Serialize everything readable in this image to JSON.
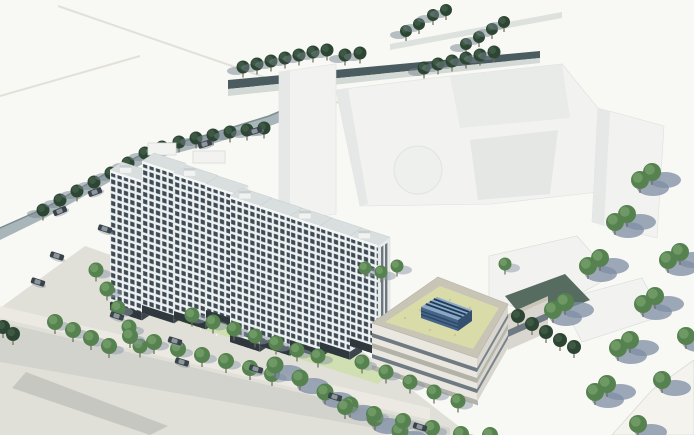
{
  "scene": {
    "type": "architectural-aerial-rendering",
    "view": "bird's-eye view of a mixed-use development massing study",
    "objects": {
      "residential_towers": "two clusters of slab apartment towers with gridded window facades",
      "green_roof_building": "low-rise banded building with sedum green roof and blue rooftop skylight",
      "context_buildings": "white untextured massing blocks of surrounding city",
      "street_trees": "rows of round street trees casting shadows",
      "cars": "small cars on roads and parking areas",
      "roads": "tree-lined streets, sidewalks and a parking lot"
    }
  },
  "colors": {
    "bg": "#f8f8f4",
    "faintLine": "#e2e0d8",
    "roadTop": "#4b5c60",
    "roadTopWalk": "#d3d9d5",
    "roadLeft": "#a9b6b9",
    "roadLeftEdge": "#7c8d92",
    "plaza": "#e0dfd8",
    "street": "#d3d3cd",
    "pavement": "#c7c7c1",
    "sidewalk": "#eceae3",
    "stall": "#fafaf8",
    "lawn": "#cfe0ae",
    "massing": "#f2f3f0",
    "massingShade": "#e5e8e6",
    "massingDeep": "#dde1df",
    "massingEdge": "#d8dbd7",
    "towerWin": "#3e4b55",
    "towerGrid": "#eef1f2",
    "towerGable": "#e7eaea",
    "towerStrip": "#59636b",
    "towerRoof": "#d9dedf",
    "towerBase": "#2f383d",
    "towerParapet": "#f6f8f8",
    "roofField": "#d9dba8",
    "roofSpeck": "#c7c994",
    "parapet": "#c8c5b6",
    "wall": "#e9e7df",
    "wallRight": "#d8d6ce",
    "wallBand": "#b2b2a8",
    "wallGlass": "#707a82",
    "skyTop": "#8aa8c6",
    "skyStripe": "#1f3c57",
    "skyFront": "#46648a",
    "skySide": "#35506f",
    "hedge": "#3c5348",
    "treeDark": "#2d4634",
    "treeDarkHi": "#44604a",
    "treeMid": "#55824f",
    "treeMidHi": "#7aa36e",
    "trunk": "#6f6a5c",
    "shadowBig": "#7d8ea4",
    "shadowSm": "#8b97a6",
    "shadowSw": "#76848d",
    "car": "#3a424a",
    "carHi": "#9aa4ab",
    "wedge": "#f4f3ee"
  },
  "towers": {
    "facadeSlope": 0.325,
    "endWidth": 12,
    "endSlope": -0.66,
    "clusters": [
      {
        "name": "tower-cluster-west",
        "slabs": [
          {
            "x": 110,
            "y": 170,
            "w": 32,
            "h": 140,
            "box": true
          },
          {
            "x": 142,
            "y": 161,
            "w": 32,
            "h": 152,
            "box": false
          },
          {
            "x": 174,
            "y": 173,
            "w": 32,
            "h": 146,
            "box": true
          },
          {
            "x": 206,
            "y": 184,
            "w": 30,
            "h": 134,
            "box": false
          }
        ]
      },
      {
        "name": "tower-cluster-east",
        "slabs": [
          {
            "x": 230,
            "y": 196,
            "w": 30,
            "h": 146,
            "box": true
          },
          {
            "x": 260,
            "y": 206,
            "w": 30,
            "h": 140,
            "box": false
          },
          {
            "x": 290,
            "y": 216,
            "w": 30,
            "h": 132,
            "box": true
          },
          {
            "x": 320,
            "y": 226,
            "w": 30,
            "h": 124,
            "box": false
          },
          {
            "x": 350,
            "y": 236,
            "w": 28,
            "h": 110,
            "box": true
          }
        ]
      }
    ]
  },
  "treeRows": [
    {
      "name": "north-upper-row",
      "kind": "treeDark",
      "shadow": "sw",
      "r": 6,
      "layer": "back",
      "pts": [
        [
          406,
          31
        ],
        [
          419,
          24
        ],
        [
          433,
          15
        ],
        [
          446,
          10
        ],
        [
          466,
          44
        ],
        [
          479,
          37
        ],
        [
          492,
          29
        ],
        [
          504,
          22
        ]
      ]
    },
    {
      "name": "north-road-row",
      "kind": "treeDark",
      "shadow": "sw",
      "r": 6.5,
      "layer": "back",
      "pts": [
        [
          243,
          67
        ],
        [
          257,
          64
        ],
        [
          271,
          61
        ],
        [
          285,
          58
        ],
        [
          299,
          55
        ],
        [
          313,
          52
        ],
        [
          327,
          50
        ],
        [
          345,
          55
        ],
        [
          360,
          53
        ],
        [
          424,
          68
        ],
        [
          438,
          64
        ],
        [
          452,
          61
        ],
        [
          466,
          58
        ],
        [
          480,
          55
        ],
        [
          494,
          52
        ]
      ]
    },
    {
      "name": "west-road-row",
      "kind": "treeDark",
      "shadow": "sw",
      "r": 6.5,
      "layer": "back",
      "pts": [
        [
          43,
          210
        ],
        [
          60,
          200
        ],
        [
          77,
          191
        ],
        [
          94,
          182
        ],
        [
          111,
          173
        ],
        [
          128,
          163
        ],
        [
          145,
          153
        ],
        [
          162,
          147
        ],
        [
          179,
          142
        ],
        [
          196,
          138
        ],
        [
          213,
          135
        ],
        [
          230,
          132
        ],
        [
          247,
          130
        ],
        [
          264,
          128
        ]
      ]
    },
    {
      "name": "west-street-row",
      "kind": "treeMid",
      "shadow": "se",
      "r": 7.5,
      "layer": "front",
      "pts": [
        [
          96,
          270
        ],
        [
          107,
          289
        ],
        [
          118,
          308
        ],
        [
          129,
          327
        ],
        [
          140,
          346
        ]
      ]
    },
    {
      "name": "south-street-upper-row",
      "kind": "treeMid",
      "shadow": "se",
      "r": 8,
      "layer": "front",
      "pts": [
        [
          55,
          322
        ],
        [
          73,
          330
        ],
        [
          91,
          338
        ],
        [
          109,
          346
        ],
        [
          130,
          336
        ],
        [
          154,
          342
        ],
        [
          178,
          349
        ],
        [
          202,
          355
        ],
        [
          226,
          361
        ],
        [
          250,
          368
        ],
        [
          272,
          374
        ]
      ]
    },
    {
      "name": "south-street-mid-row",
      "kind": "treeMid",
      "shadow": "seBig",
      "r": 8.5,
      "layer": "front",
      "pts": [
        [
          275,
          365
        ],
        [
          300,
          378
        ],
        [
          325,
          392
        ],
        [
          350,
          405
        ],
        [
          375,
          418
        ],
        [
          400,
          431
        ]
      ]
    },
    {
      "name": "south-street-lower-row",
      "kind": "treeMid",
      "shadow": "se",
      "r": 8,
      "layer": "front",
      "pts": [
        [
          345,
          407
        ],
        [
          374,
          414
        ],
        [
          403,
          421
        ],
        [
          432,
          428
        ],
        [
          461,
          434
        ],
        [
          490,
          435
        ]
      ]
    },
    {
      "name": "tower-lawn-row",
      "kind": "treeMid",
      "shadow": "se",
      "r": 7.5,
      "layer": "front",
      "pts": [
        [
          192,
          315
        ],
        [
          213,
          322
        ],
        [
          234,
          329
        ],
        [
          255,
          336
        ],
        [
          276,
          343
        ],
        [
          297,
          350
        ],
        [
          318,
          356
        ]
      ]
    },
    {
      "name": "green-building-front-row",
      "kind": "treeMid",
      "shadow": "se",
      "r": 7.5,
      "layer": "front",
      "pts": [
        [
          362,
          362
        ],
        [
          386,
          372
        ],
        [
          410,
          382
        ],
        [
          434,
          392
        ],
        [
          458,
          401
        ]
      ]
    },
    {
      "name": "green-building-hedge",
      "kind": "treeDark",
      "shadow": "none",
      "r": 7,
      "layer": "front",
      "pts": [
        [
          518,
          316
        ],
        [
          532,
          324
        ],
        [
          546,
          332
        ],
        [
          560,
          340
        ],
        [
          574,
          347
        ]
      ]
    },
    {
      "name": "east-row-1",
      "kind": "treeMid",
      "shadow": "seBig",
      "r": 9,
      "layer": "front",
      "pts": [
        [
          640,
          180
        ],
        [
          652,
          172
        ],
        [
          615,
          222
        ],
        [
          627,
          214
        ],
        [
          588,
          266
        ],
        [
          600,
          258
        ],
        [
          553,
          310
        ],
        [
          565,
          302
        ]
      ]
    },
    {
      "name": "east-row-2",
      "kind": "treeMid",
      "shadow": "seBig",
      "r": 9,
      "layer": "front",
      "pts": [
        [
          668,
          260
        ],
        [
          680,
          252
        ],
        [
          643,
          304
        ],
        [
          655,
          296
        ],
        [
          618,
          348
        ],
        [
          630,
          340
        ],
        [
          595,
          392
        ],
        [
          607,
          384
        ]
      ]
    },
    {
      "name": "east-row-3",
      "kind": "treeMid",
      "shadow": "seBig",
      "r": 9,
      "layer": "front",
      "pts": [
        [
          686,
          336
        ],
        [
          662,
          380
        ],
        [
          638,
          424
        ]
      ]
    },
    {
      "name": "courtyard-row",
      "kind": "treeMid",
      "shadow": "se",
      "r": 6.5,
      "layer": "front",
      "pts": [
        [
          365,
          268
        ],
        [
          381,
          272
        ],
        [
          397,
          266
        ],
        [
          505,
          264
        ]
      ]
    },
    {
      "name": "southwest-corner-trees",
      "kind": "treeDark",
      "shadow": "none",
      "r": 7,
      "layer": "front",
      "pts": [
        [
          3,
          327
        ],
        [
          13,
          334
        ]
      ]
    }
  ],
  "cars": [
    {
      "x": 255,
      "y": 131,
      "a": -17,
      "layer": "back"
    },
    {
      "x": 205,
      "y": 144,
      "a": -17,
      "layer": "back"
    },
    {
      "x": 95,
      "y": 192,
      "a": -20,
      "layer": "back"
    },
    {
      "x": 60,
      "y": 211,
      "a": -22,
      "layer": "back"
    },
    {
      "x": 105,
      "y": 229,
      "a": 18,
      "layer": "front"
    },
    {
      "x": 57,
      "y": 256,
      "a": 18,
      "layer": "front"
    },
    {
      "x": 38,
      "y": 282,
      "a": 18,
      "layer": "front"
    },
    {
      "x": 117,
      "y": 316,
      "a": 18,
      "layer": "front"
    },
    {
      "x": 175,
      "y": 341,
      "a": 17,
      "layer": "front"
    },
    {
      "x": 182,
      "y": 362,
      "a": 17,
      "layer": "front"
    },
    {
      "x": 256,
      "y": 369,
      "a": 17,
      "layer": "front"
    },
    {
      "x": 335,
      "y": 397,
      "a": 17,
      "layer": "front"
    },
    {
      "x": 420,
      "y": 427,
      "a": 17,
      "layer": "front"
    }
  ]
}
